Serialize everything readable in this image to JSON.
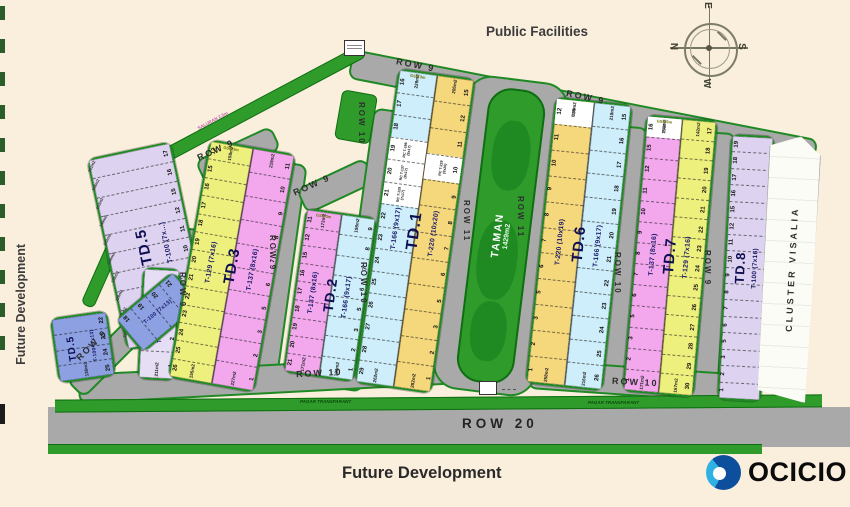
{
  "colors": {
    "bg": "#faeedd",
    "road": "#a9a9a9",
    "green": "#2f9b2b",
    "green_dark": "#0e6e11",
    "border_green": "#1f8a24",
    "yellow": "#eef07e",
    "pink": "#f3a8ee",
    "blue_lt": "#cdeefa",
    "orange": "#f6d87c",
    "lavender": "#ddd3f0",
    "lavender_lt": "#e6def5",
    "blue": "#8ca0e2",
    "logo_blue_dark": "#0d4f9c",
    "logo_blue_light": "#2fb2e3"
  },
  "labels": {
    "public_facilities": "Public Facilities",
    "future_dev_left": "Future Development",
    "future_dev_bottom": "Future Development",
    "cluster_visalia": "CLUSTER VISALIA",
    "taman_title": "TAMAN",
    "taman_area": "1429m2",
    "pagar_left": "PAGAR TRANSPARANT",
    "pagar_right": "PAGAR TRANSPARANT",
    "saluran": "SALURAN 2.5m"
  },
  "compass": {
    "n": "N",
    "e": "E",
    "s": "S",
    "w": "W"
  },
  "logo": {
    "text": "OCICIO"
  },
  "road_labels": [
    {
      "t": "ROW 9",
      "x": 396,
      "y": 60,
      "r": 11
    },
    {
      "t": "ROW 9",
      "x": 566,
      "y": 92,
      "r": 12
    },
    {
      "t": "ROW 9",
      "x": 196,
      "y": 145,
      "r": -24
    },
    {
      "t": "ROW 9",
      "x": 292,
      "y": 180,
      "r": -24
    },
    {
      "t": "ROW 9",
      "x": 72,
      "y": 340,
      "r": -45
    },
    {
      "t": "ROW 9",
      "x": 178,
      "y": 272,
      "v": 1
    },
    {
      "t": "ROW 9",
      "x": 268,
      "y": 235,
      "v": 1
    },
    {
      "t": "ROW 10",
      "x": 357,
      "y": 102,
      "v": 1
    },
    {
      "t": "ROW 10",
      "x": 359,
      "y": 262,
      "v": 1
    },
    {
      "t": "ROW 11",
      "x": 462,
      "y": 200,
      "v": 1
    },
    {
      "t": "ROW 11",
      "x": 516,
      "y": 196,
      "v": 1
    },
    {
      "t": "ROW 10",
      "x": 613,
      "y": 252,
      "v": 1
    },
    {
      "t": "ROW 9",
      "x": 703,
      "y": 250,
      "v": 1
    },
    {
      "t": "ROW 10",
      "x": 296,
      "y": 368,
      "r": -3
    },
    {
      "t": "ROW 10",
      "x": 612,
      "y": 377,
      "r": 3
    },
    {
      "t": "ROW 20",
      "x": 462,
      "y": 416,
      "r": 0,
      "big": 1
    }
  ],
  "blocks": [
    {
      "name": "td5-main",
      "big": "TD.5",
      "bigfs": 15,
      "bigx": 44,
      "typex": 72,
      "x": 106,
      "y": 148,
      "w": 82,
      "h": 192,
      "rot": -12,
      "strips": [
        {
          "color": "lavender",
          "type": "T-100 (7x...)",
          "typefs": 7,
          "lots": [
            "17",
            "16",
            "15",
            "12",
            "11",
            "10",
            "9",
            "8",
            "7",
            "6"
          ],
          "num_side": "right",
          "areas": [
            "161m2",
            "158m2",
            "153m2",
            "149m2",
            "143m2",
            "140m2",
            "136m2",
            "128m2",
            "121m2",
            "110m2"
          ]
        }
      ]
    },
    {
      "name": "td5-vertical",
      "typex": 55,
      "x": 140,
      "y": 268,
      "w": 34,
      "h": 108,
      "rot": 3,
      "strips": [
        {
          "color": "lavender_lt",
          "type": "T-100 (7x16)",
          "typefs": 6,
          "lots": [
            "5",
            "3",
            "2",
            "1"
          ],
          "num_side": "right",
          "bottom_area": "211m2"
        }
      ]
    },
    {
      "name": "td5-blue-row",
      "row": 1,
      "x": 120,
      "y": 290,
      "w": 72,
      "h": 40,
      "rot": -40,
      "strips": [
        {
          "color": "blue",
          "type": "T-100 (7x13)",
          "typefs": 5.5,
          "lots": [
            "18",
            "19",
            "20",
            "21"
          ],
          "num_side": "top"
        }
      ]
    },
    {
      "name": "td5-blue-corner",
      "big": "TD.5",
      "bigfs": 10,
      "bigx": 30,
      "typex": 70,
      "x": 54,
      "y": 314,
      "w": 54,
      "h": 62,
      "rot": -8,
      "strips": [
        {
          "color": "blue",
          "type": "T-100 (7x13)",
          "typefs": 5,
          "lots": [
            "22",
            "23",
            "24",
            "25"
          ],
          "num_side": "right",
          "bottom_area": "136m2"
        }
      ]
    },
    {
      "name": "td3",
      "big": "TD.3",
      "bigfs": 15,
      "x": 188,
      "y": 145,
      "w": 84,
      "h": 238,
      "rot": 10,
      "strips": [
        {
          "color": "yellow",
          "type": "T-129 (7x16)",
          "lots": [
            "12",
            "15",
            "16",
            "17",
            "18",
            "19",
            "20",
            "21",
            "22",
            "23",
            "24",
            "25",
            "26"
          ],
          "num_side": "left",
          "top_area": "158m2",
          "bottom_area": "155m2",
          "gsb": "GSB 3m"
        },
        {
          "color": "pink",
          "type": "T-137 (8x16)",
          "lots": [
            "11",
            "10",
            "9",
            "8",
            "7",
            "6",
            "5",
            "3",
            "2",
            "1"
          ],
          "num_side": "right",
          "top_area": "219m2",
          "bottom_area": "227m2"
        }
      ]
    },
    {
      "name": "td2",
      "big": "TD.2",
      "bigfs": 14,
      "x": 294,
      "y": 212,
      "w": 68,
      "h": 162,
      "rot": 8,
      "strips": [
        {
          "color": "pink",
          "type": "T-137 (8x16)",
          "lots": [
            "11",
            "12",
            "15",
            "16",
            "17",
            "18",
            "19",
            "20",
            "21"
          ],
          "num_side": "left",
          "top_area": "173m2",
          "bottom_area": "171m2",
          "gsb": "GSB 3m"
        },
        {
          "color": "blue_lt",
          "type": "T-166 (9x17)",
          "lots": [
            "9",
            "8",
            "7",
            "6",
            "5",
            "3",
            "2",
            "1"
          ],
          "num_side": "right",
          "top_area": "198m2",
          "bottom_area": "190m2"
        }
      ]
    },
    {
      "name": "td1",
      "big": "TD.1",
      "bigfs": 16,
      "x": 376,
      "y": 72,
      "w": 74,
      "h": 314,
      "rot": 8,
      "strips": [
        {
          "color": "blue_lt",
          "type": "T-166 (9x17)",
          "lots": [
            "16",
            "17",
            "18",
            "19",
            "20",
            "21",
            "22",
            "23",
            "24",
            "25",
            "26",
            "27",
            "28",
            "29"
          ],
          "num_side": "left",
          "top_area": "229m2",
          "bottom_area": "262m2",
          "gsb": "GSB 3m",
          "specials": {
            "19": "RC T-166 (9x17)",
            "20": "RC T-137 (8x17)",
            "21": "RC T-129 (7x17)"
          }
        },
        {
          "color": "orange",
          "type": "T-220 (10x20)",
          "lots": [
            "15",
            "12",
            "11",
            "10",
            "9",
            "8",
            "7",
            "6",
            "5",
            "3",
            "2",
            "1"
          ],
          "num_side": "right",
          "top_area": "205m2",
          "bottom_area": "282m2",
          "specials": {
            "10": "RC T-229 (9x20)"
          }
        }
      ]
    },
    {
      "name": "td6",
      "big": "TD.6",
      "bigfs": 15,
      "x": 540,
      "y": 100,
      "w": 74,
      "h": 284,
      "rot": 6,
      "strips": [
        {
          "color": "orange",
          "type": "T-220 (10x19)",
          "lots": [
            "12",
            "11",
            "10",
            "9",
            "8",
            "7",
            "6",
            "5",
            "3",
            "2",
            "1"
          ],
          "num_side": "left",
          "top_area": "238m2",
          "bottom_area": "258m2",
          "specials": {
            "12": "T-166"
          }
        },
        {
          "color": "blue_lt",
          "type": "T-166 (9x17)",
          "lots": [
            "15",
            "16",
            "17",
            "18",
            "19",
            "20",
            "21",
            "22",
            "23",
            "24",
            "25",
            "26"
          ],
          "num_side": "right",
          "top_area": "218m2",
          "bottom_area": "216m2"
        }
      ]
    },
    {
      "name": "td7",
      "big": "TD.7",
      "bigfs": 15,
      "x": 634,
      "y": 117,
      "w": 68,
      "h": 274,
      "rot": 5,
      "strips": [
        {
          "color": "pink",
          "type": "T-137 (8x16)",
          "lots": [
            "16",
            "15",
            "12",
            "11",
            "10",
            "9",
            "8",
            "7",
            "6",
            "5",
            "3",
            "2",
            "1"
          ],
          "num_side": "left",
          "top_area": "156m2",
          "bottom_area": "171m2",
          "gsb": "GSB 3m",
          "specials": {
            "16": "T-129"
          }
        },
        {
          "color": "yellow",
          "type": "T-129 (7x16)",
          "lots": [
            "17",
            "18",
            "19",
            "20",
            "21",
            "22",
            "23",
            "24",
            "25",
            "26",
            "27",
            "28",
            "29",
            "30"
          ],
          "num_side": "right",
          "top_area": "142m2",
          "bottom_area": "167m2"
        }
      ]
    },
    {
      "name": "td8",
      "big": "TD.8",
      "bigfs": 13,
      "bigx": 36,
      "typex": 72,
      "x": 724,
      "y": 135,
      "w": 40,
      "h": 262,
      "rot": 3,
      "strips": [
        {
          "color": "lavender",
          "type": "T-100 (7x16)",
          "typefs": 6.5,
          "lots": [
            "19",
            "18",
            "17",
            "16",
            "15",
            "12",
            "11",
            "10",
            "9",
            "8",
            "7",
            "6",
            "5",
            "3",
            "2",
            "1"
          ],
          "num_side": "left"
        }
      ]
    }
  ]
}
